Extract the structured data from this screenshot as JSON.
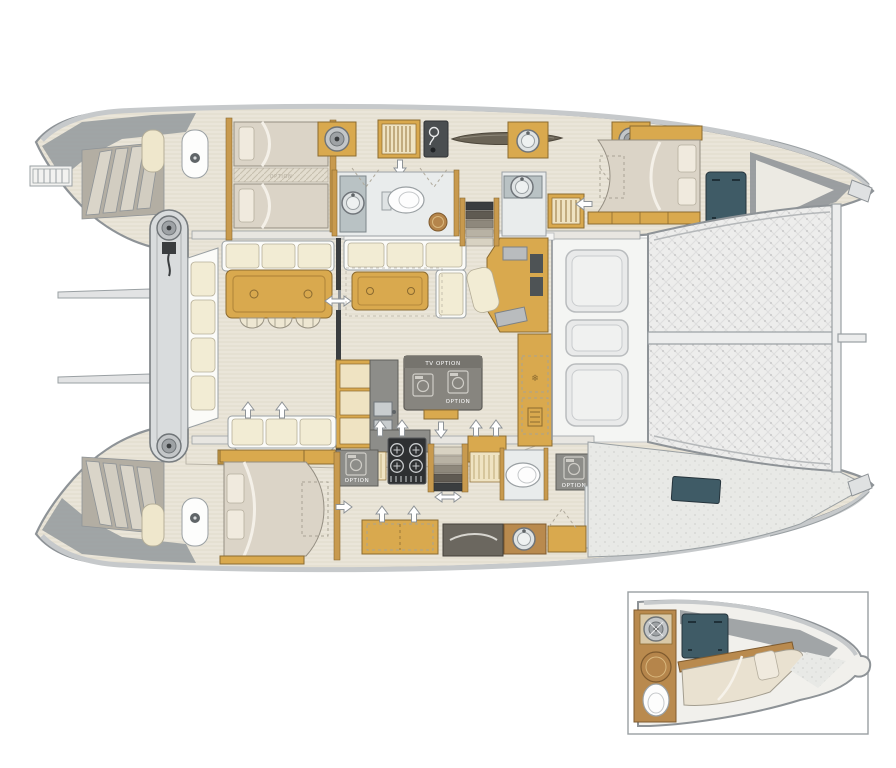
{
  "labels": {
    "tv_option": "TV OPTION",
    "option": "OPTION"
  },
  "icons": {
    "snowflake": "❄",
    "washer-icon": "front-loading appliance drum",
    "winch-icon": "round deck winch",
    "shower-icon": "round teak shower grate"
  },
  "colors": {
    "background": "#ffffff",
    "outline_gray": "#8e9397",
    "deck_gray": "#e8e9e7",
    "floor_linen": "#eae5d9",
    "wood": "#d9a94e",
    "wood_dark": "#b98a4e",
    "cushion_cream": "#f2ecd4",
    "mattress": "#dbd4c7",
    "counter_gray": "#8d8d89",
    "island_gray": "#87857f",
    "teal": "#3f5b66",
    "stove_black": "#2e3032",
    "trampoline": "#ececec",
    "label_white": "#ffffff"
  }
}
